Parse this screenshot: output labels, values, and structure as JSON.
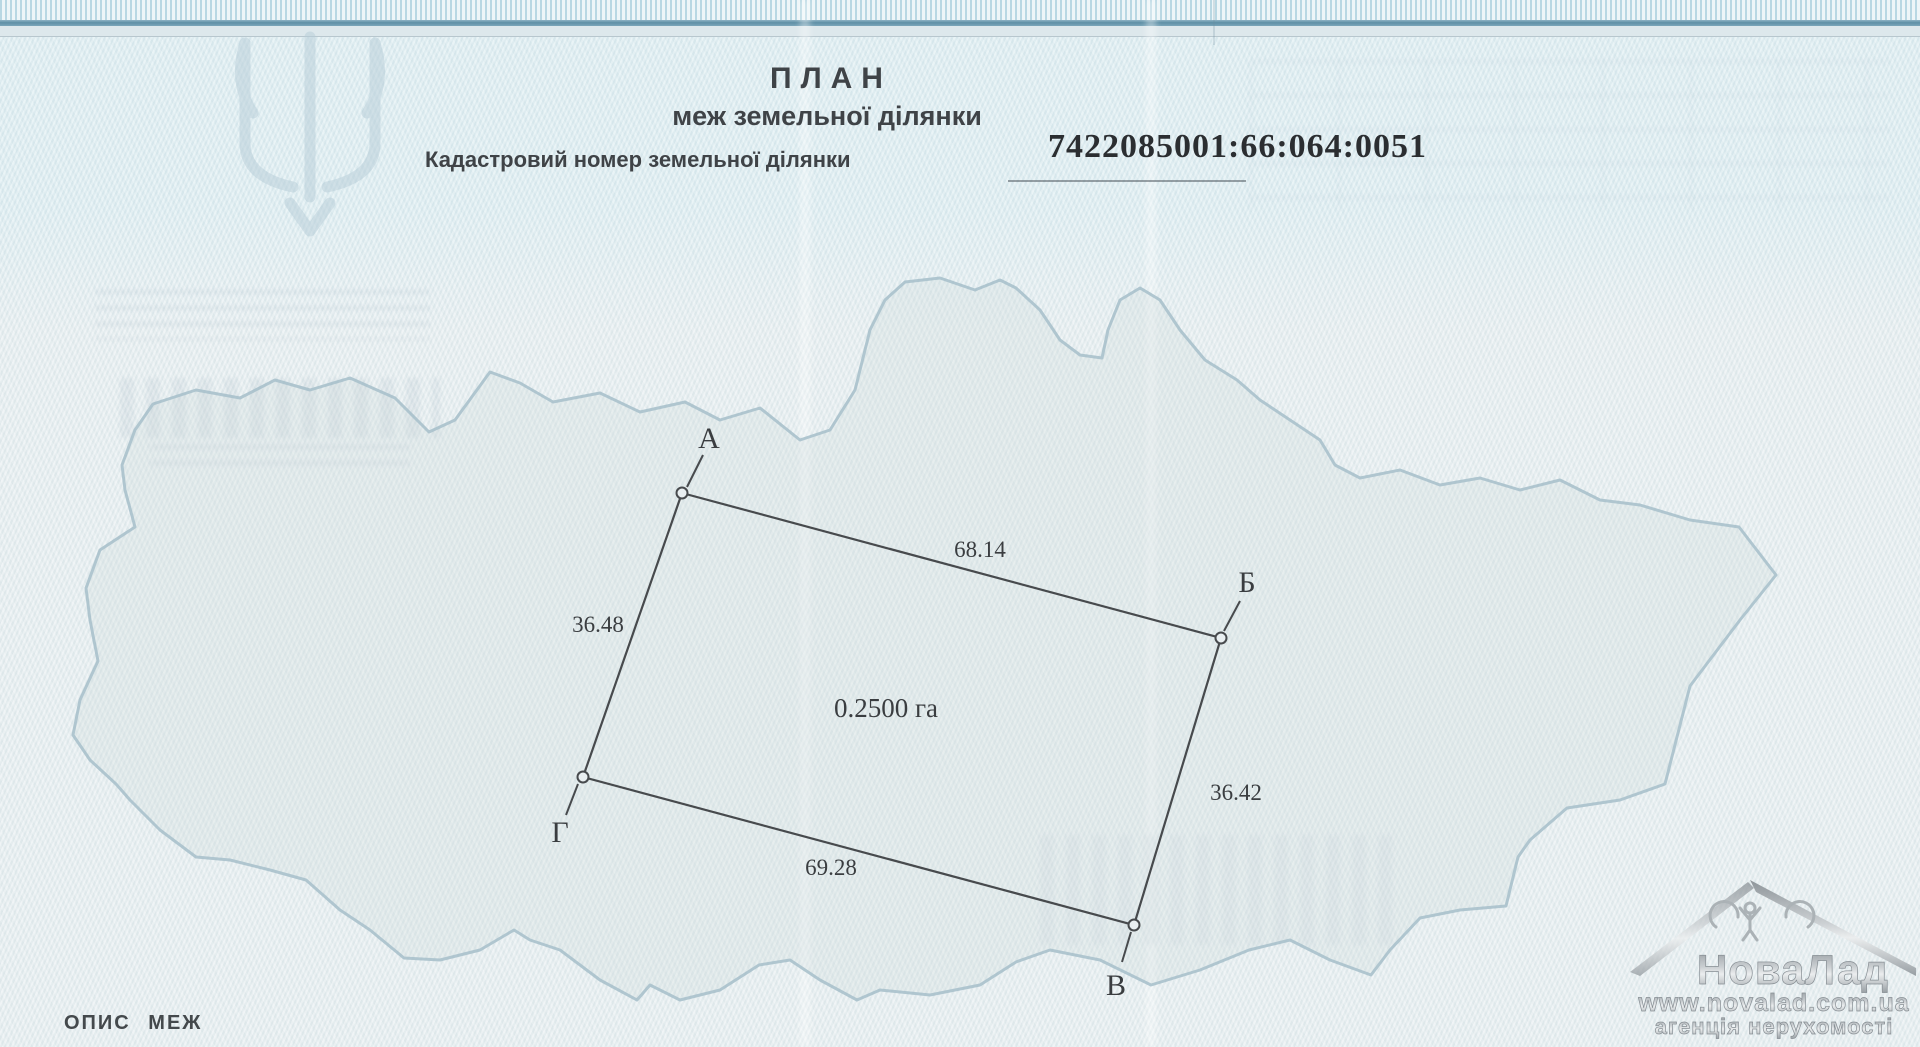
{
  "document": {
    "title": "ПЛАН",
    "subtitle": "меж земельної ділянки",
    "cadastral": {
      "label": "Кадастровий номер земельної ділянки",
      "number": "7422085001:66:064:0051"
    },
    "footer_label": "ОПИС МЕЖ"
  },
  "plot": {
    "area": "0.2500 га",
    "vertices": [
      {
        "name": "А"
      },
      {
        "name": "Б"
      },
      {
        "name": "В"
      },
      {
        "name": "Г"
      }
    ],
    "sides": [
      {
        "edge": "А-Б",
        "length": "68.14"
      },
      {
        "edge": "Б-В",
        "length": "36.42"
      },
      {
        "edge": "В-Г",
        "length": "69.28"
      },
      {
        "edge": "Г-А",
        "length": "36.48"
      }
    ]
  },
  "watermark": {
    "brand": "НоваЛад",
    "site": "www.novalad.com.ua",
    "tagline": "агенція нерухомості"
  },
  "colors": {
    "paper": "#e7eef0",
    "map_outline": "#a6bfca",
    "ink": "#3a3d40",
    "top_band": "#5f90a6",
    "watermark_silver": "#9aa1a6"
  }
}
